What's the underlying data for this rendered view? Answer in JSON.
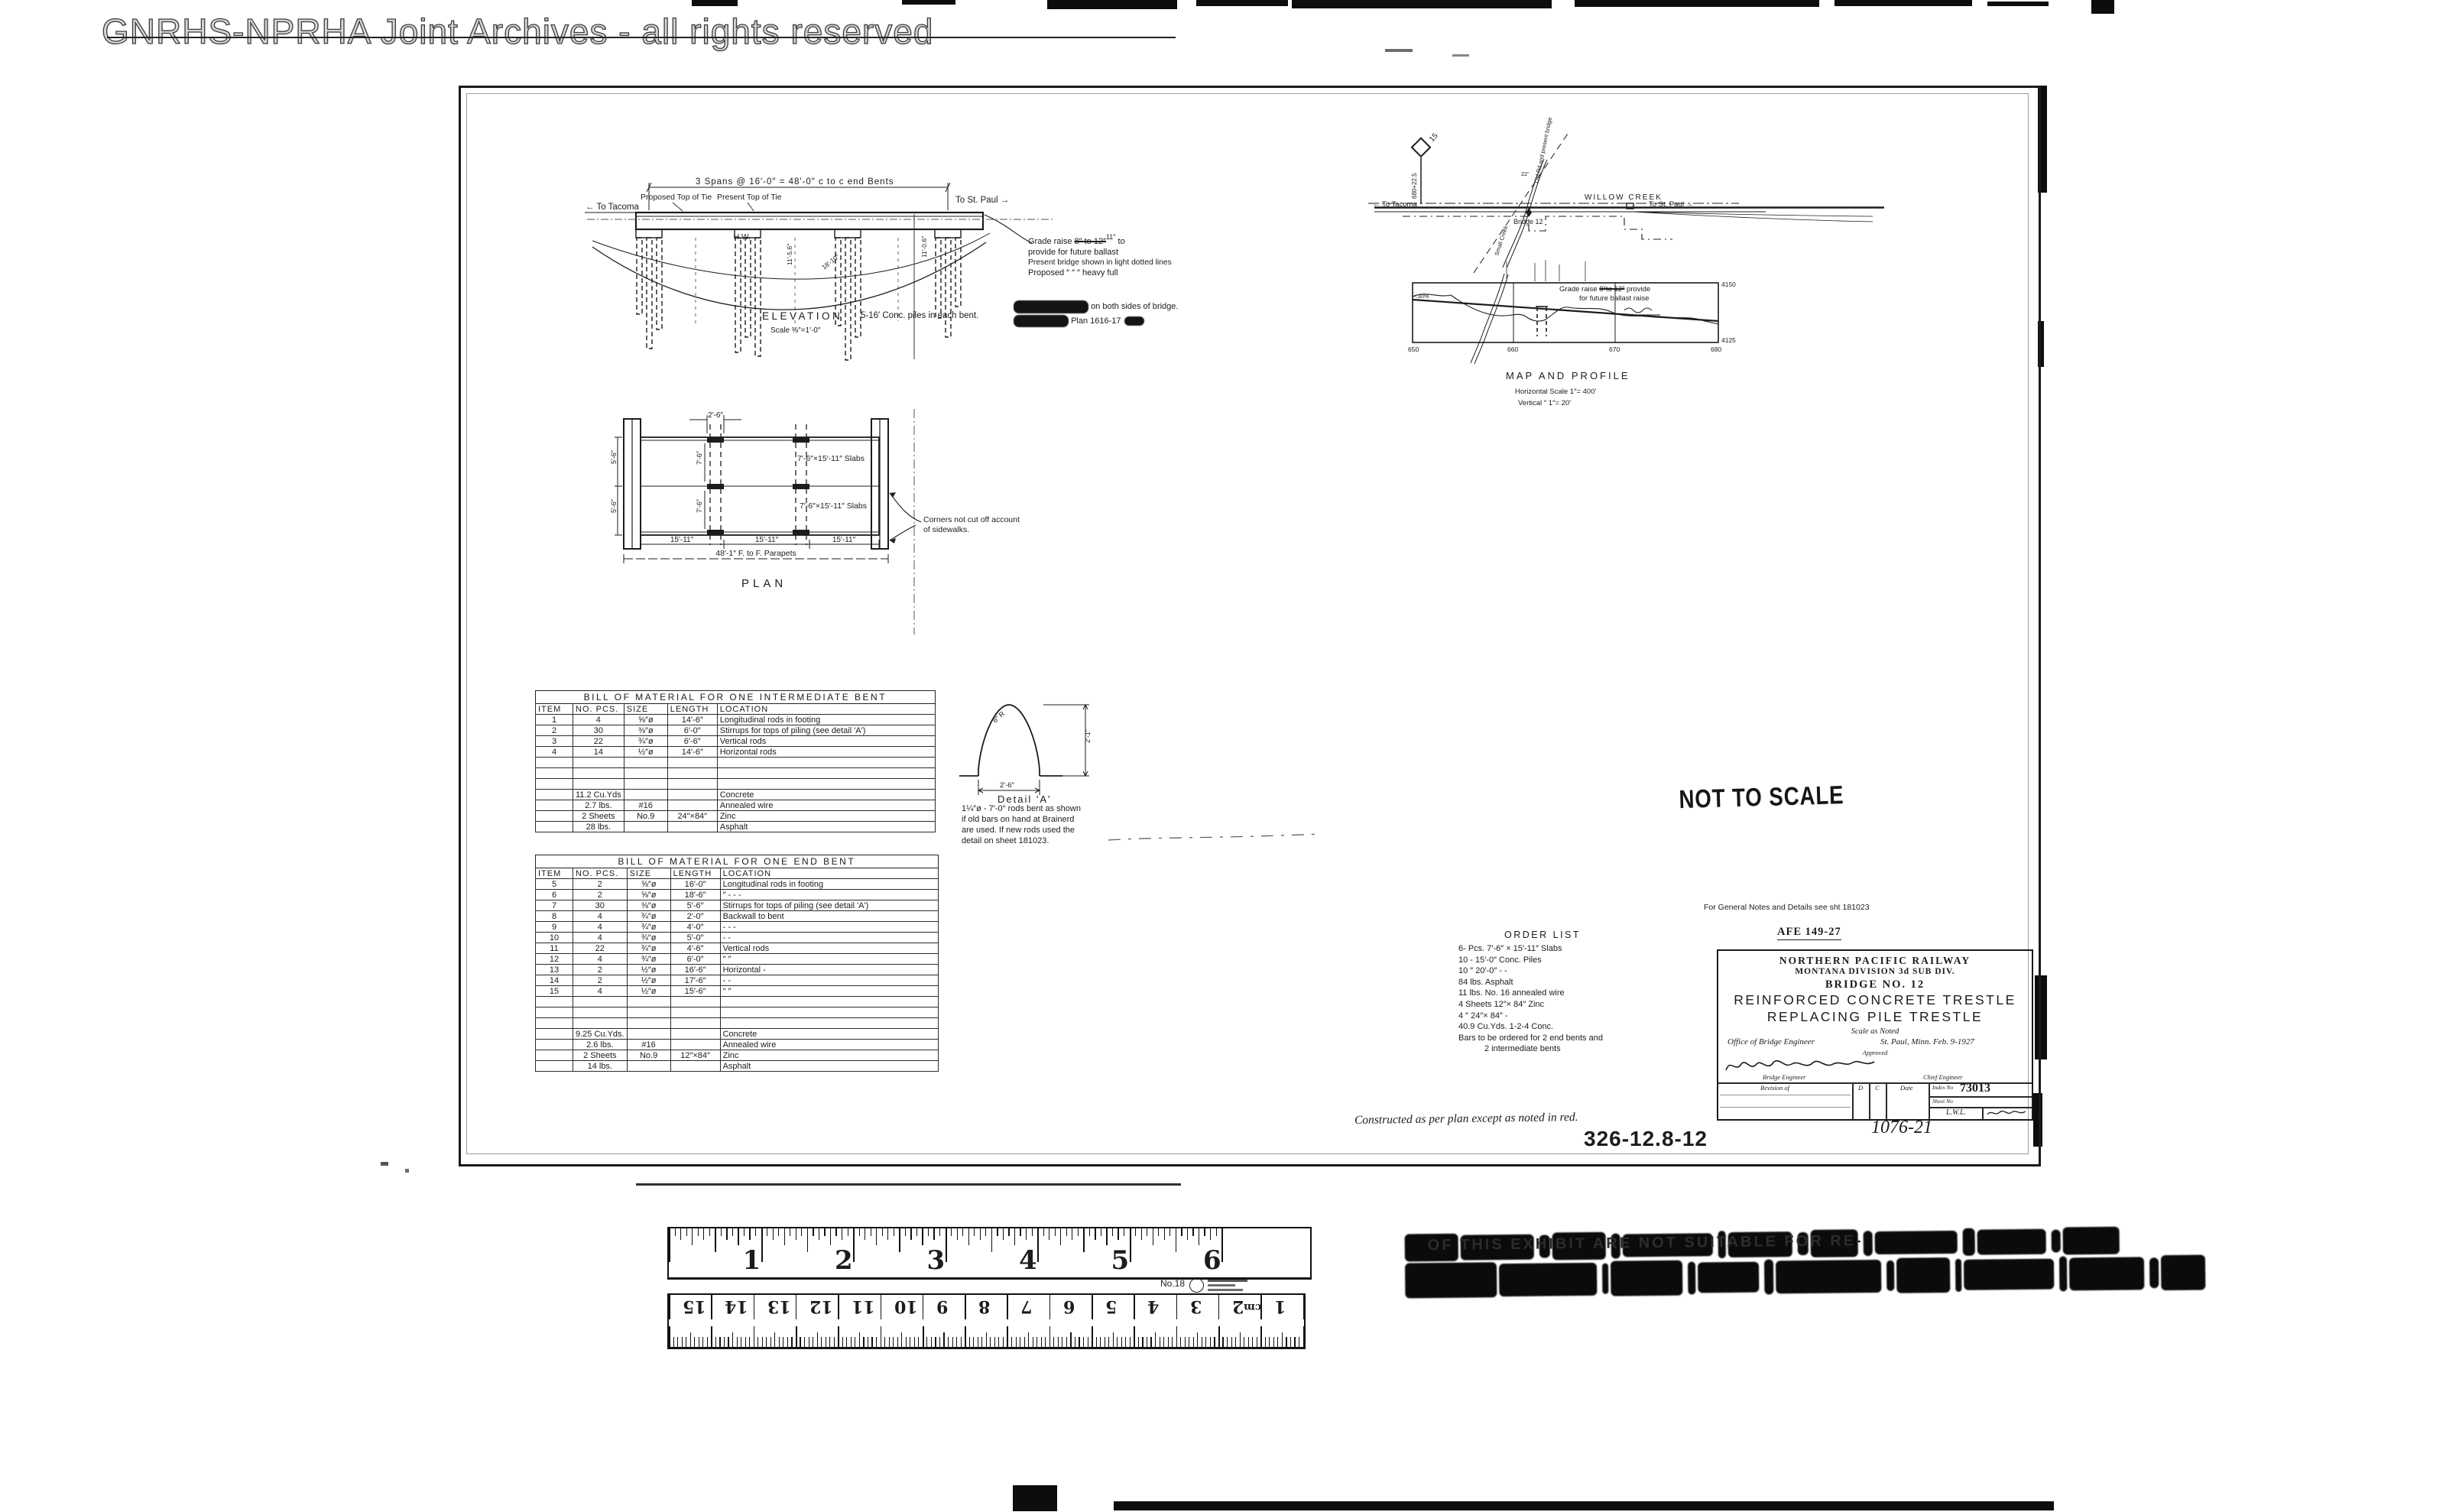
{
  "watermark": {
    "text": "GNRHS-NPRHA Joint Archives - all rights reserved"
  },
  "elevation": {
    "title": "ELEVATION",
    "scale": "Scale ⅛″=1′-0″",
    "span_dim": "3 Spans @ 16′-0″ = 48′-0″ c to c end Bents",
    "to_tacoma": "← To Tacoma",
    "to_stpaul": "To St. Paul →",
    "proposed_top": "Proposed Top of Tie",
    "present_top": "Present Top of Tie",
    "piles_note": "5-16′ Conc. piles in each bent.",
    "hw": "H.W.",
    "dim_a": "11′-5.6″",
    "dim_b": "11′-0.6″",
    "dim_c": "18′-10″",
    "grade_note": {
      "lead": "Grade raise ",
      "struck": "8″ to 12″",
      "corr": "11″",
      "tail": " to",
      "l2": "provide for future ballast",
      "l3": "Present bridge shown in light dotted lines",
      "l4": "Proposed   ″      ″      ″ heavy full"
    },
    "inked_note": {
      "l1_tail": "on both sides of bridge.",
      "l2_tail": "Plan  1616-17"
    }
  },
  "plan": {
    "title": "PLAN",
    "slab_label_top": "7′-6″×15′-11″ Slabs",
    "slab_label_bottom": "7′-6″×15′-11″ Slabs",
    "dim_top": "2′-6″",
    "dim_left_upper": "5′-6″",
    "dim_left_lower": "5′-6″",
    "dim_gauge_upper": "7′-6″",
    "dim_gauge_lower": "7′-6″",
    "dim_panel": "15′-11″",
    "dim_total": "48′-1″ F. to F. Parapets",
    "corner_note_l1": "Corners not cut off account",
    "corner_note_l2": "of sidewalks."
  },
  "map": {
    "milepost": "15",
    "station_no": "680+22.5",
    "to_tacoma": "← To Tacoma",
    "to_stpaul": "To St. Paul →",
    "station": "WILLOW CREEK",
    "bridge": "Bridge 12",
    "creek": "Small Creek",
    "road": "Old Rd and present bridge",
    "dim": "22′"
  },
  "profile": {
    "title": "MAP AND PROFILE",
    "h_scale": "Horizontal Scale 1″= 400′",
    "v_scale": "Vertical       ″      1″= 20′",
    "elev_top": "4150",
    "elev_bot": "4125",
    "stations": [
      "650",
      "660",
      "670",
      "680"
    ],
    "grade_lead": "Grade raise ",
    "grade_struck": "8″to 12″",
    "grade_tail": " provide",
    "grade_l2": "for future ballast raise",
    "grade_pct": "-.30%"
  },
  "tables": [
    {
      "title": "BILL OF MATERIAL FOR ONE INTERMEDIATE BENT",
      "headers": [
        "ITEM",
        "NO. PCS.",
        "SIZE",
        "LENGTH",
        "LOCATION"
      ],
      "rows": [
        [
          "1",
          "4",
          "⅝″ø",
          "14′-6″",
          "Longitudinal rods in footing"
        ],
        [
          "2",
          "30",
          "⅜″ø",
          "6′-0″",
          "Stirrups for tops of piling (see detail 'A')"
        ],
        [
          "3",
          "22",
          "¾″ø",
          "6′-6″",
          "Vertical rods"
        ],
        [
          "4",
          "14",
          "½″ø",
          "14′-6″",
          "Horizontal rods"
        ],
        [
          "",
          "",
          "",
          "",
          ""
        ],
        [
          "",
          "",
          "",
          "",
          ""
        ],
        [
          "",
          "",
          "",
          "",
          ""
        ],
        [
          "",
          "11.2 Cu.Yds",
          "",
          "",
          "Concrete"
        ],
        [
          "",
          "2.7 lbs.",
          "#16",
          "",
          "Annealed wire"
        ],
        [
          "",
          "2 Sheets",
          "No.9",
          "24″×84″",
          "Zinc"
        ],
        [
          "",
          "28 lbs.",
          "",
          "",
          "Asphalt"
        ]
      ]
    },
    {
      "title": "BILL OF MATERIAL FOR ONE END BENT",
      "headers": [
        "ITEM",
        "NO. PCS.",
        "SIZE",
        "LENGTH",
        "LOCATION"
      ],
      "rows": [
        [
          "5",
          "2",
          "⅝″ø",
          "16′-0″",
          "Longitudinal rods in footing"
        ],
        [
          "6",
          "2",
          "⅝″ø",
          "18′-6″",
          "″        -        -        -"
        ],
        [
          "7",
          "30",
          "⅜″ø",
          "5′-6″",
          "Stirrups for tops of piling (see detail 'A')"
        ],
        [
          "8",
          "4",
          "¾″ø",
          "2′-0″",
          "Backwall to bent"
        ],
        [
          "9",
          "4",
          "¾″ø",
          "4′-0″",
          "-        -        -"
        ],
        [
          "10",
          "4",
          "¾″ø",
          "5′-0″",
          "-        -"
        ],
        [
          "11",
          "22",
          "¾″ø",
          "4′-6″",
          "Vertical rods"
        ],
        [
          "12",
          "4",
          "¾″ø",
          "6′-0″",
          "″        ″"
        ],
        [
          "13",
          "2",
          "½″ø",
          "16′-6″",
          "Horizontal   -"
        ],
        [
          "14",
          "2",
          "½″ø",
          "17′-6″",
          "-        -"
        ],
        [
          "15",
          "4",
          "½″ø",
          "15′-6″",
          "″        ″"
        ],
        [
          "",
          "",
          "",
          "",
          ""
        ],
        [
          "",
          "",
          "",
          "",
          ""
        ],
        [
          "",
          "",
          "",
          "",
          ""
        ],
        [
          "",
          "9.25 Cu.Yds.",
          "",
          "",
          "Concrete"
        ],
        [
          "",
          "2.6 lbs.",
          "#16",
          "",
          "Annealed wire"
        ],
        [
          "",
          "2 Sheets",
          "No.9",
          "12″×84″",
          "Zinc"
        ],
        [
          "",
          "14 lbs.",
          "",
          "",
          "Asphalt"
        ]
      ]
    }
  ],
  "detail_a": {
    "title": "Detail 'A'",
    "radius": "8″ R",
    "height_dim": "2′-1″",
    "width_dim": "2′-6″",
    "caption": [
      "1¼″ø - 7′-0″ rods bent as shown",
      "if old bars on hand at Brainerd",
      "are used. If new rods used the",
      "detail on sheet 181023."
    ]
  },
  "order_list": {
    "title": "ORDER LIST",
    "items": [
      "6- Pcs.   7′-6″ × 15′-11″ Slabs",
      "10   -      15′-0″ Conc. Piles",
      "10   ″      20′-0″    -       -",
      "84 lbs.   Asphalt",
      "11 lbs.  No. 16 annealed wire",
      "4 Sheets   12″× 84″ Zinc",
      "4      ″       24″× 84″    -",
      "40.9 Cu.Yds.  1-2-4 Conc.",
      "Bars to be ordered for 2 end bents and",
      "2 intermediate bents"
    ]
  },
  "stamps": {
    "not_to_scale": "NOT TO SCALE",
    "general_note": "For General Notes and Details see sht 181023",
    "afe": "AFE 149-27",
    "constructed": "Constructed as per plan except as noted in red.",
    "file_no": "326-12.8-12",
    "tracing_no": "1076-21"
  },
  "title_block": {
    "railway": "NORTHERN PACIFIC RAILWAY",
    "division": "MONTANA DIVISION    3d SUB DIV.",
    "bridge_no": "BRIDGE NO. 12",
    "title1": "REINFORCED CONCRETE TRESTLE",
    "title2": "REPLACING PILE TRESTLE",
    "scale": "Scale as Noted",
    "office": "Office of Bridge Engineer",
    "place_date": "St. Paul, Minn. Feb. 9-1927",
    "approved": "Approved",
    "bridge_eng": "Bridge Engineer",
    "chief_eng": "Chief Engineer",
    "revision": "Revision of",
    "d": "D",
    "c": "C",
    "date": "Date",
    "index_label": "Index No",
    "index_no": "73013",
    "sheet_label": "Sheet No",
    "initials": "L.W.L."
  },
  "ruler": {
    "inch_numbers": [
      "1",
      "2",
      "3",
      "4",
      "5",
      "6"
    ],
    "model": "No.18",
    "cm_numbers": [
      "15",
      "14",
      "13",
      "12",
      "11",
      "10",
      "9",
      "8",
      "7",
      "6",
      "5",
      "4",
      "3",
      "2",
      "1"
    ],
    "cm_label": "cm"
  },
  "ink_stamp": {
    "fragment": "OF THIS EXHIBIT ARE NOT SUITABLE FOR RE-"
  }
}
